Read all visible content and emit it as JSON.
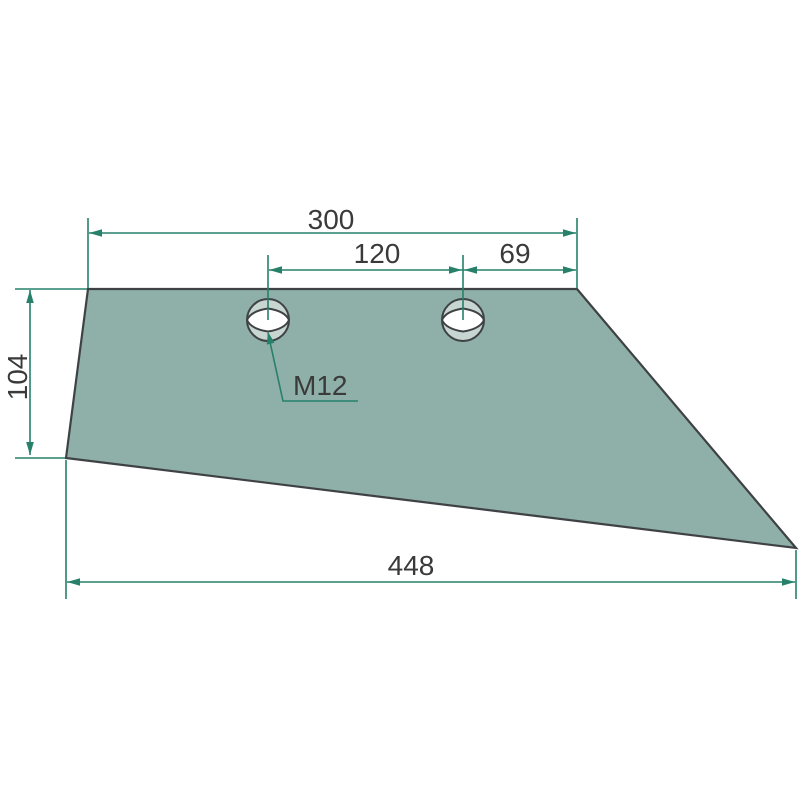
{
  "colors": {
    "background": "#ffffff",
    "part_fill": "#8fafa9",
    "part_outline": "#3f4245",
    "hole_fill": "#c8d6d1",
    "hole_inner": "#ffffff",
    "dimension": "#26806a",
    "text": "#3a3a3a"
  },
  "dimensions": {
    "top_width": "300",
    "hole_spacing": "120",
    "hole_to_edge": "69",
    "left_height": "104",
    "overall_length": "448",
    "thread": "M12"
  }
}
